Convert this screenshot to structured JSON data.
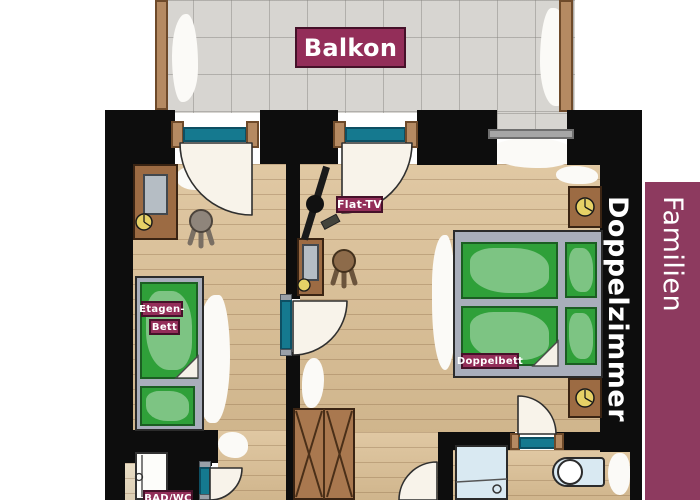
{
  "page": {
    "background": "#ffffff",
    "width": 700,
    "height": 500,
    "type": "hotel room floor plan"
  },
  "banner": {
    "text_regular": "Familien",
    "text_bold": "Doppelzimmer",
    "full_text": "Familien Doppelzimmer",
    "bg_color": "#8d3a5f",
    "text_color": "#ffffff"
  },
  "plan": {
    "labels": {
      "balcony": "Balkon",
      "tv": "Flat-TV",
      "bunk_bed_line1": "Etagen-",
      "bunk_bed_line2": "Bett",
      "double_bed": "Doppelbett",
      "bathroom": "BAD/WC"
    },
    "label_style": {
      "bg_color": "#932e59",
      "border_color": "#451129",
      "text_color": "#ffffff"
    },
    "rooms": [
      {
        "id": "balcony",
        "label": "Balkon",
        "floor": "gray tile",
        "features": [
          "railing-left",
          "railing-right",
          "glass-door",
          "glass-door",
          "window"
        ]
      },
      {
        "id": "kids-bedroom",
        "furniture": [
          "wardrobe-with-mirror",
          "stool",
          "bunk-bed"
        ]
      },
      {
        "id": "hallway",
        "furniture": [
          "flat-tv",
          "tv-cabinet",
          "stool",
          "x-door-closet"
        ]
      },
      {
        "id": "main-bedroom",
        "furniture": [
          "nightstand",
          "double-bed",
          "nightstand"
        ]
      },
      {
        "id": "bathroom-left",
        "label": "BAD/WC",
        "furniture": [
          "shower-cabin"
        ]
      },
      {
        "id": "bathroom-right",
        "furniture": [
          "shower",
          "sink"
        ]
      }
    ],
    "colors": {
      "wall": "#0d0d0d",
      "wood_floor": "#dbbf94",
      "balcony_tile": "#d7d5d1",
      "door_glass": "#15798f",
      "furniture_wood": "#9c6b43",
      "bed_green": "#2fa039",
      "bed_frame_gray": "#a9aebb",
      "fixture_blue": "#d9e9f2",
      "knob_yellow": "#e6d166"
    }
  }
}
